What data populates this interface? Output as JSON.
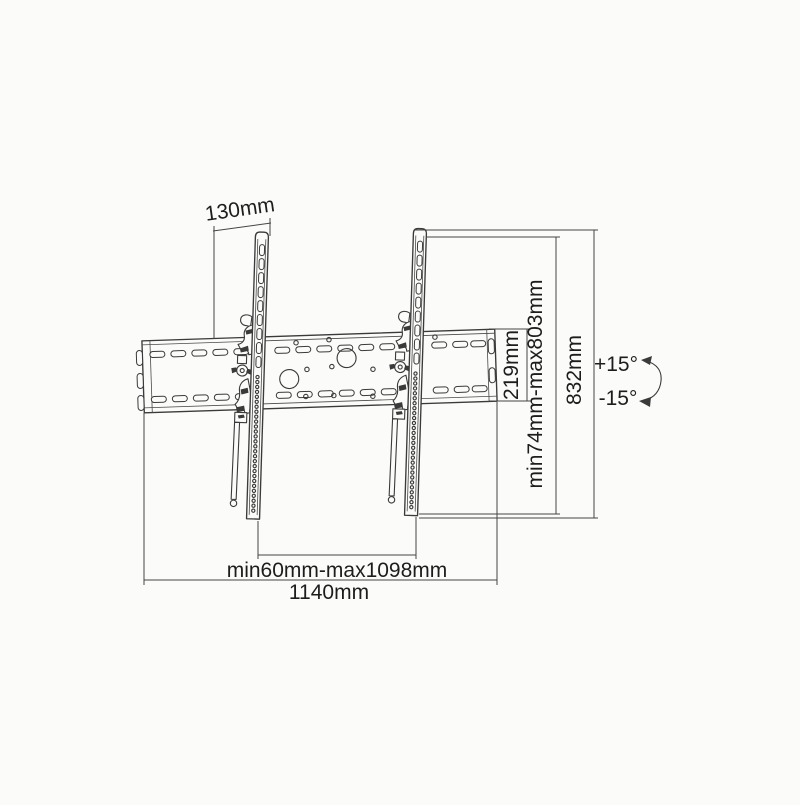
{
  "diagram": {
    "dimensions": {
      "bracket_offset": "130mm",
      "plate_height": "219mm",
      "vertical_range": "min74mm-max803mm",
      "arm_height": "832mm",
      "horizontal_range": "min60mm-max1098mm",
      "plate_width": "1140mm"
    },
    "tilt": {
      "up_label": "+15°",
      "down_label": "-15°"
    },
    "colors": {
      "line": "#3a3a3a",
      "text": "#1d1d1d",
      "background": "#fbfbf9"
    }
  }
}
